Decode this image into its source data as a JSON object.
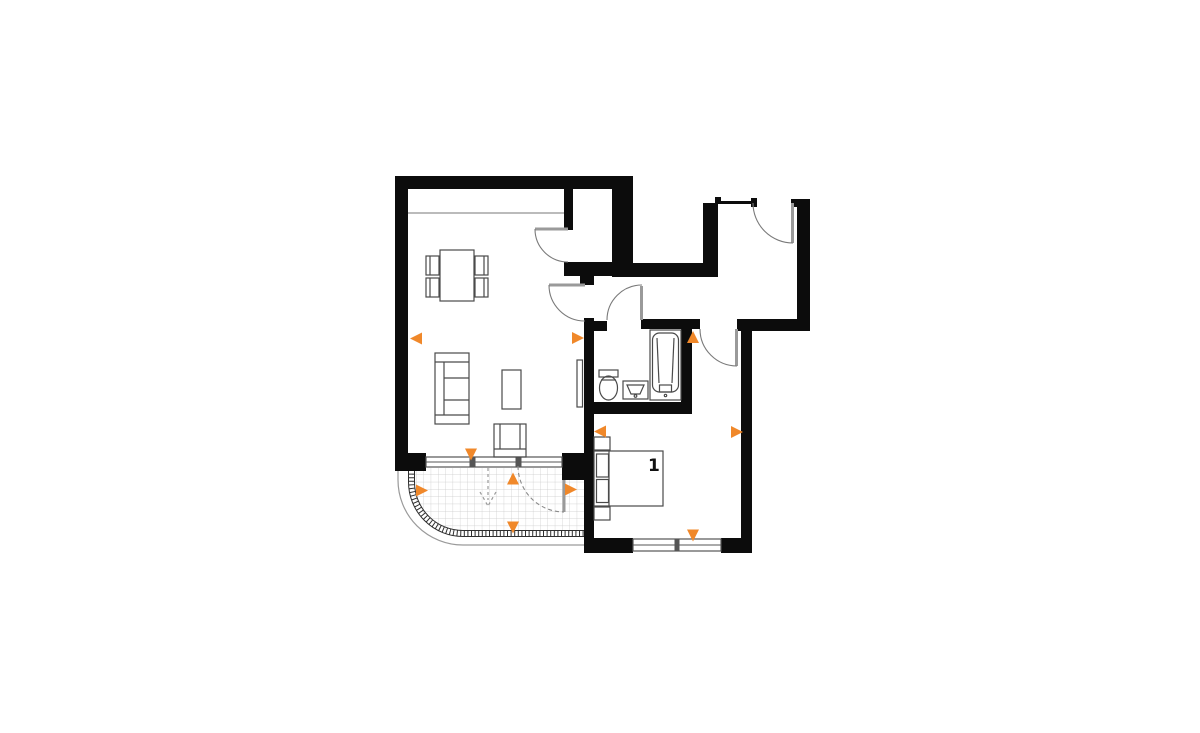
{
  "plan": {
    "room_label": "1",
    "marker_color": "#F0882A",
    "wall_color": "#0c0c0c",
    "rooms": [
      "living-room-with-kitchen",
      "wardrobe-niche",
      "hallway",
      "bathroom",
      "bedroom",
      "entry-hall",
      "balcony"
    ],
    "furniture": [
      "dining-table-with-four-chairs",
      "sofa",
      "coffee-table",
      "armchair",
      "radiator-panel",
      "toilet",
      "washbasin",
      "bathtub",
      "double-bed-with-pillows",
      "two-nightstands"
    ],
    "markers": [
      {
        "x": 416,
        "y": 338.5,
        "dir": "left"
      },
      {
        "x": 578,
        "y": 338,
        "dir": "right"
      },
      {
        "x": 471,
        "y": 454.5,
        "dir": "down"
      },
      {
        "x": 422,
        "y": 490.5,
        "dir": "right"
      },
      {
        "x": 513,
        "y": 478.5,
        "dir": "up"
      },
      {
        "x": 513,
        "y": 527.5,
        "dir": "down"
      },
      {
        "x": 571,
        "y": 489.5,
        "dir": "right"
      },
      {
        "x": 693,
        "y": 337,
        "dir": "up"
      },
      {
        "x": 600,
        "y": 431.5,
        "dir": "left"
      },
      {
        "x": 737,
        "y": 432,
        "dir": "right"
      },
      {
        "x": 693,
        "y": 535.5,
        "dir": "down"
      }
    ]
  }
}
